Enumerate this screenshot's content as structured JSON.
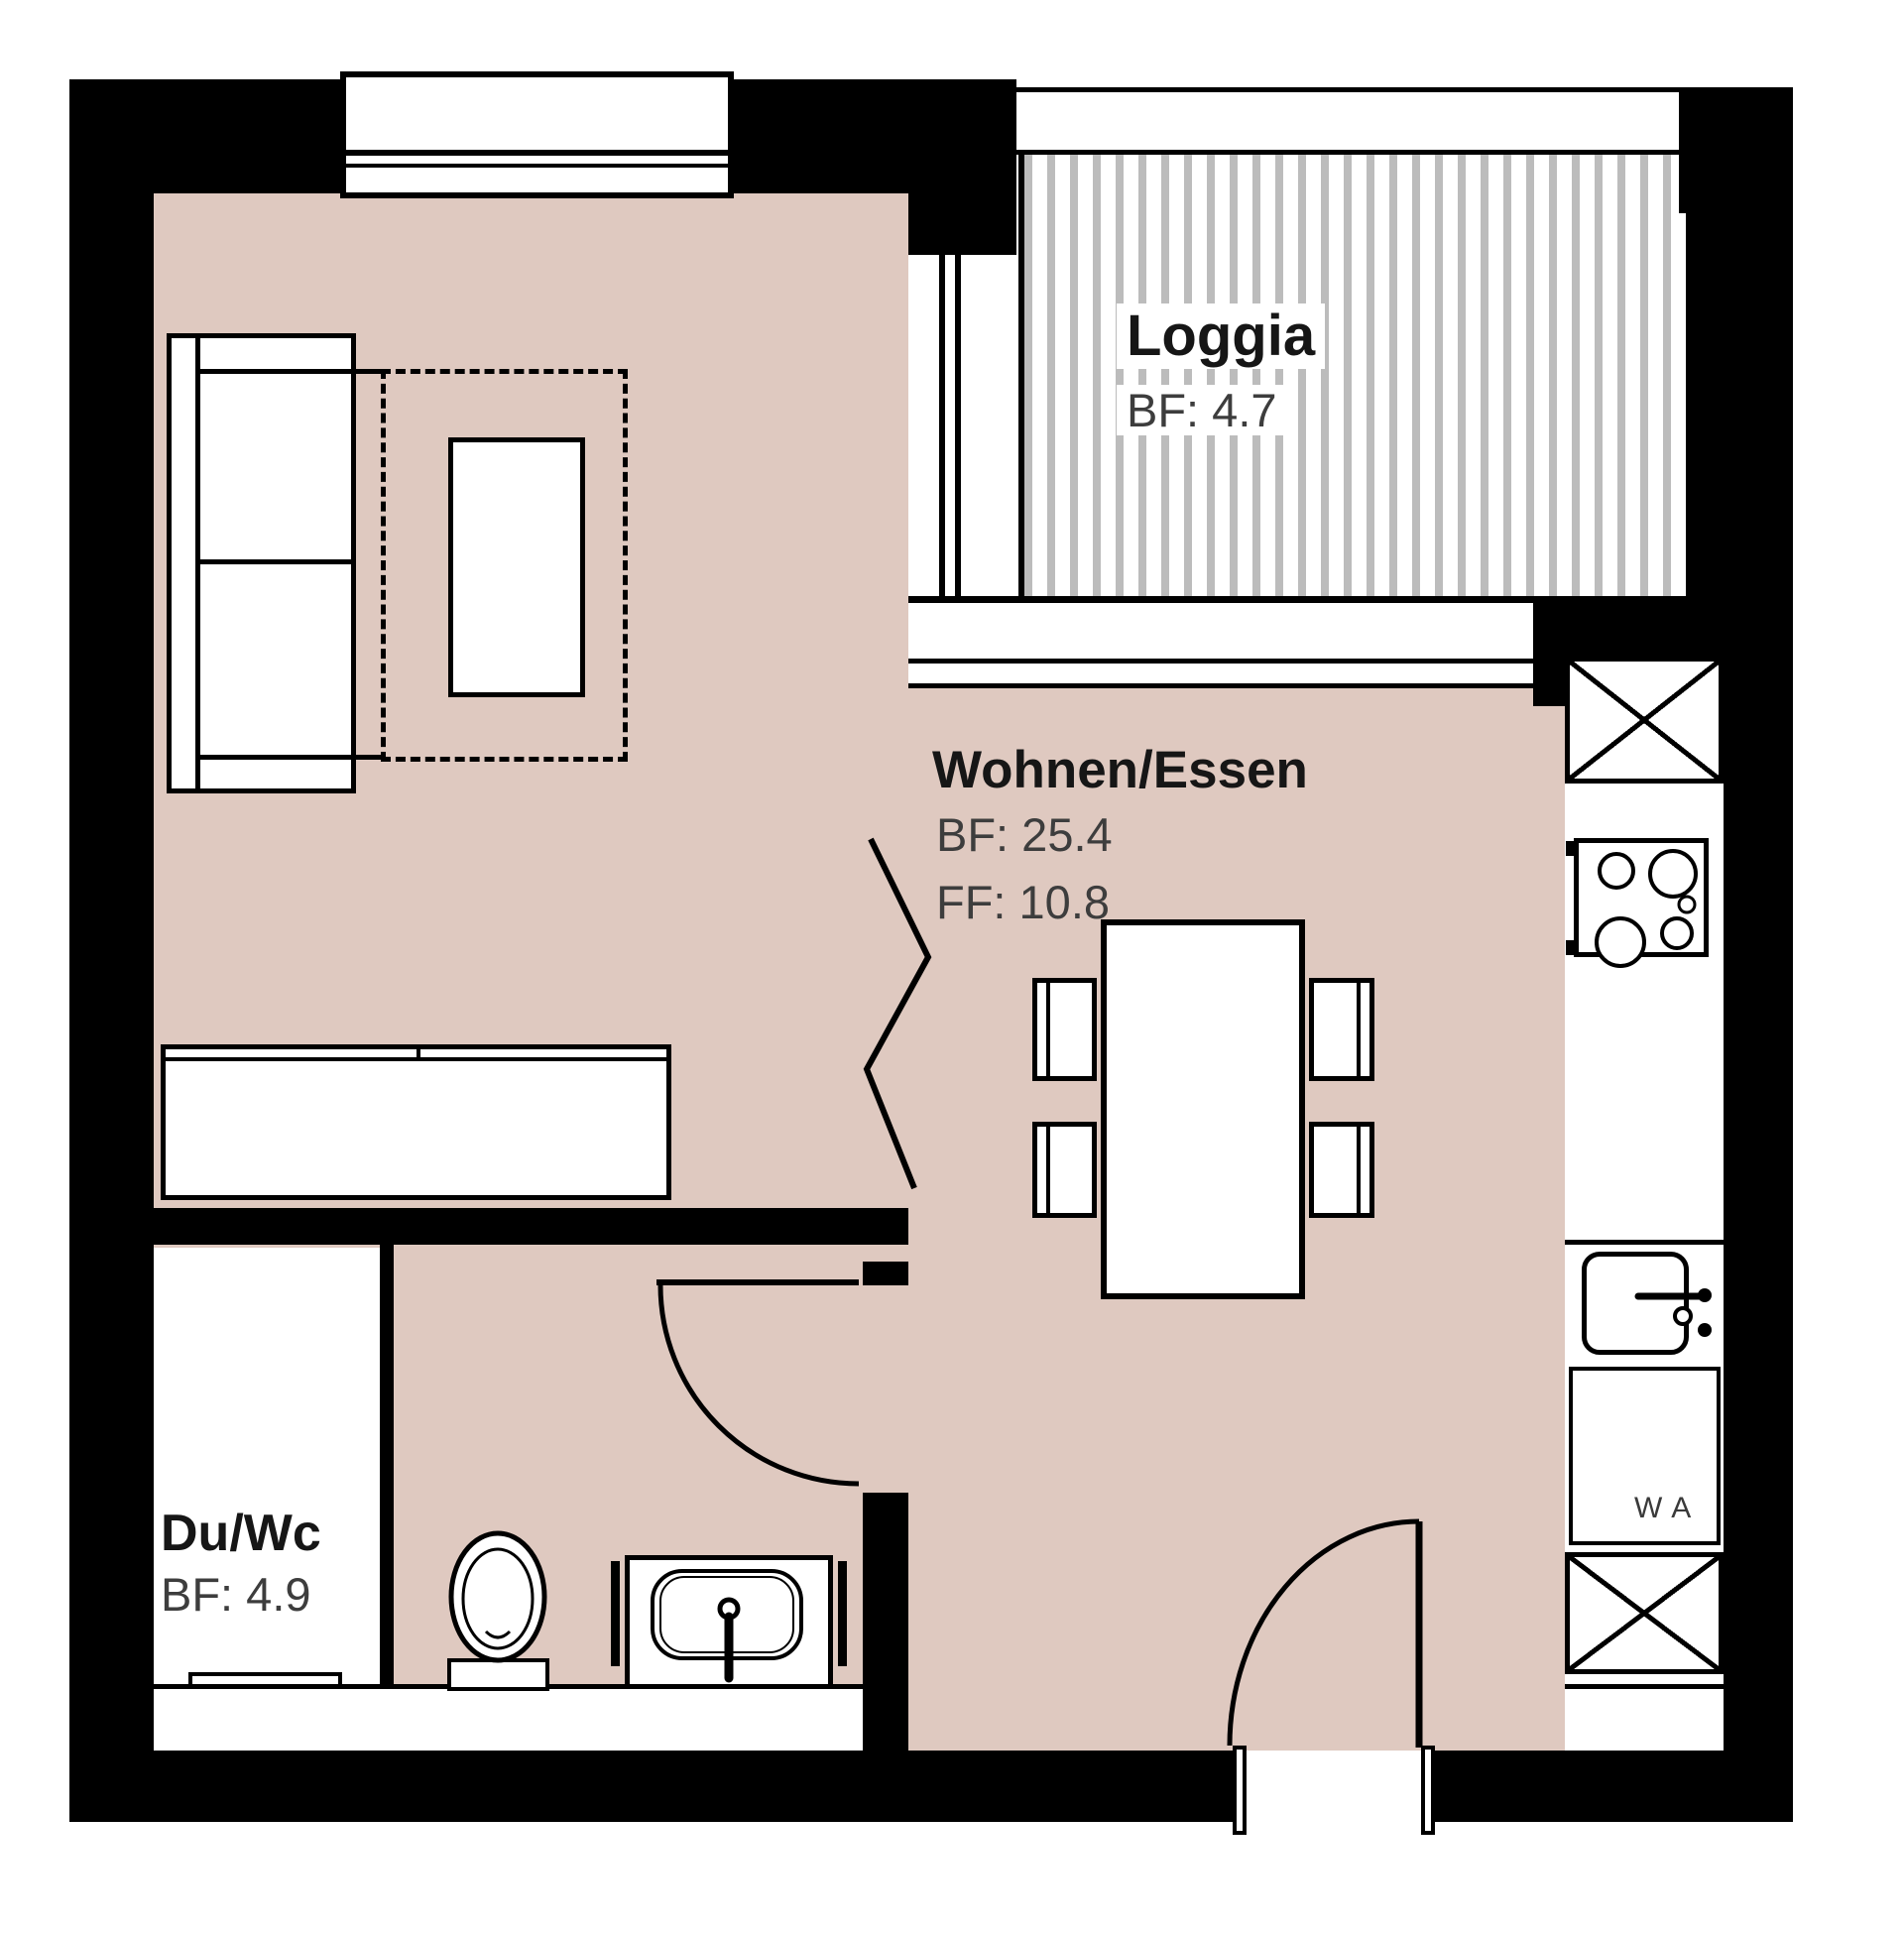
{
  "plan_title": "Apartment floor plan",
  "rooms": [
    {
      "id": "loggia",
      "name": "Loggia",
      "bf": "BF: 4.7"
    },
    {
      "id": "wohnen-essen",
      "name": "Wohnen/Essen",
      "bf": "BF: 25.4",
      "ff": "FF: 10.8"
    },
    {
      "id": "du-wc",
      "name": "Du/Wc",
      "bf": "BF: 4.9"
    }
  ],
  "appliances": {
    "washer_label": "WA"
  },
  "colors": {
    "floor": "#dfc9c0",
    "wall": "#000000",
    "loggia_hatch_stripe": "#bcbcbc",
    "title_text": "#161616",
    "area_text": "#3d3d3d"
  }
}
